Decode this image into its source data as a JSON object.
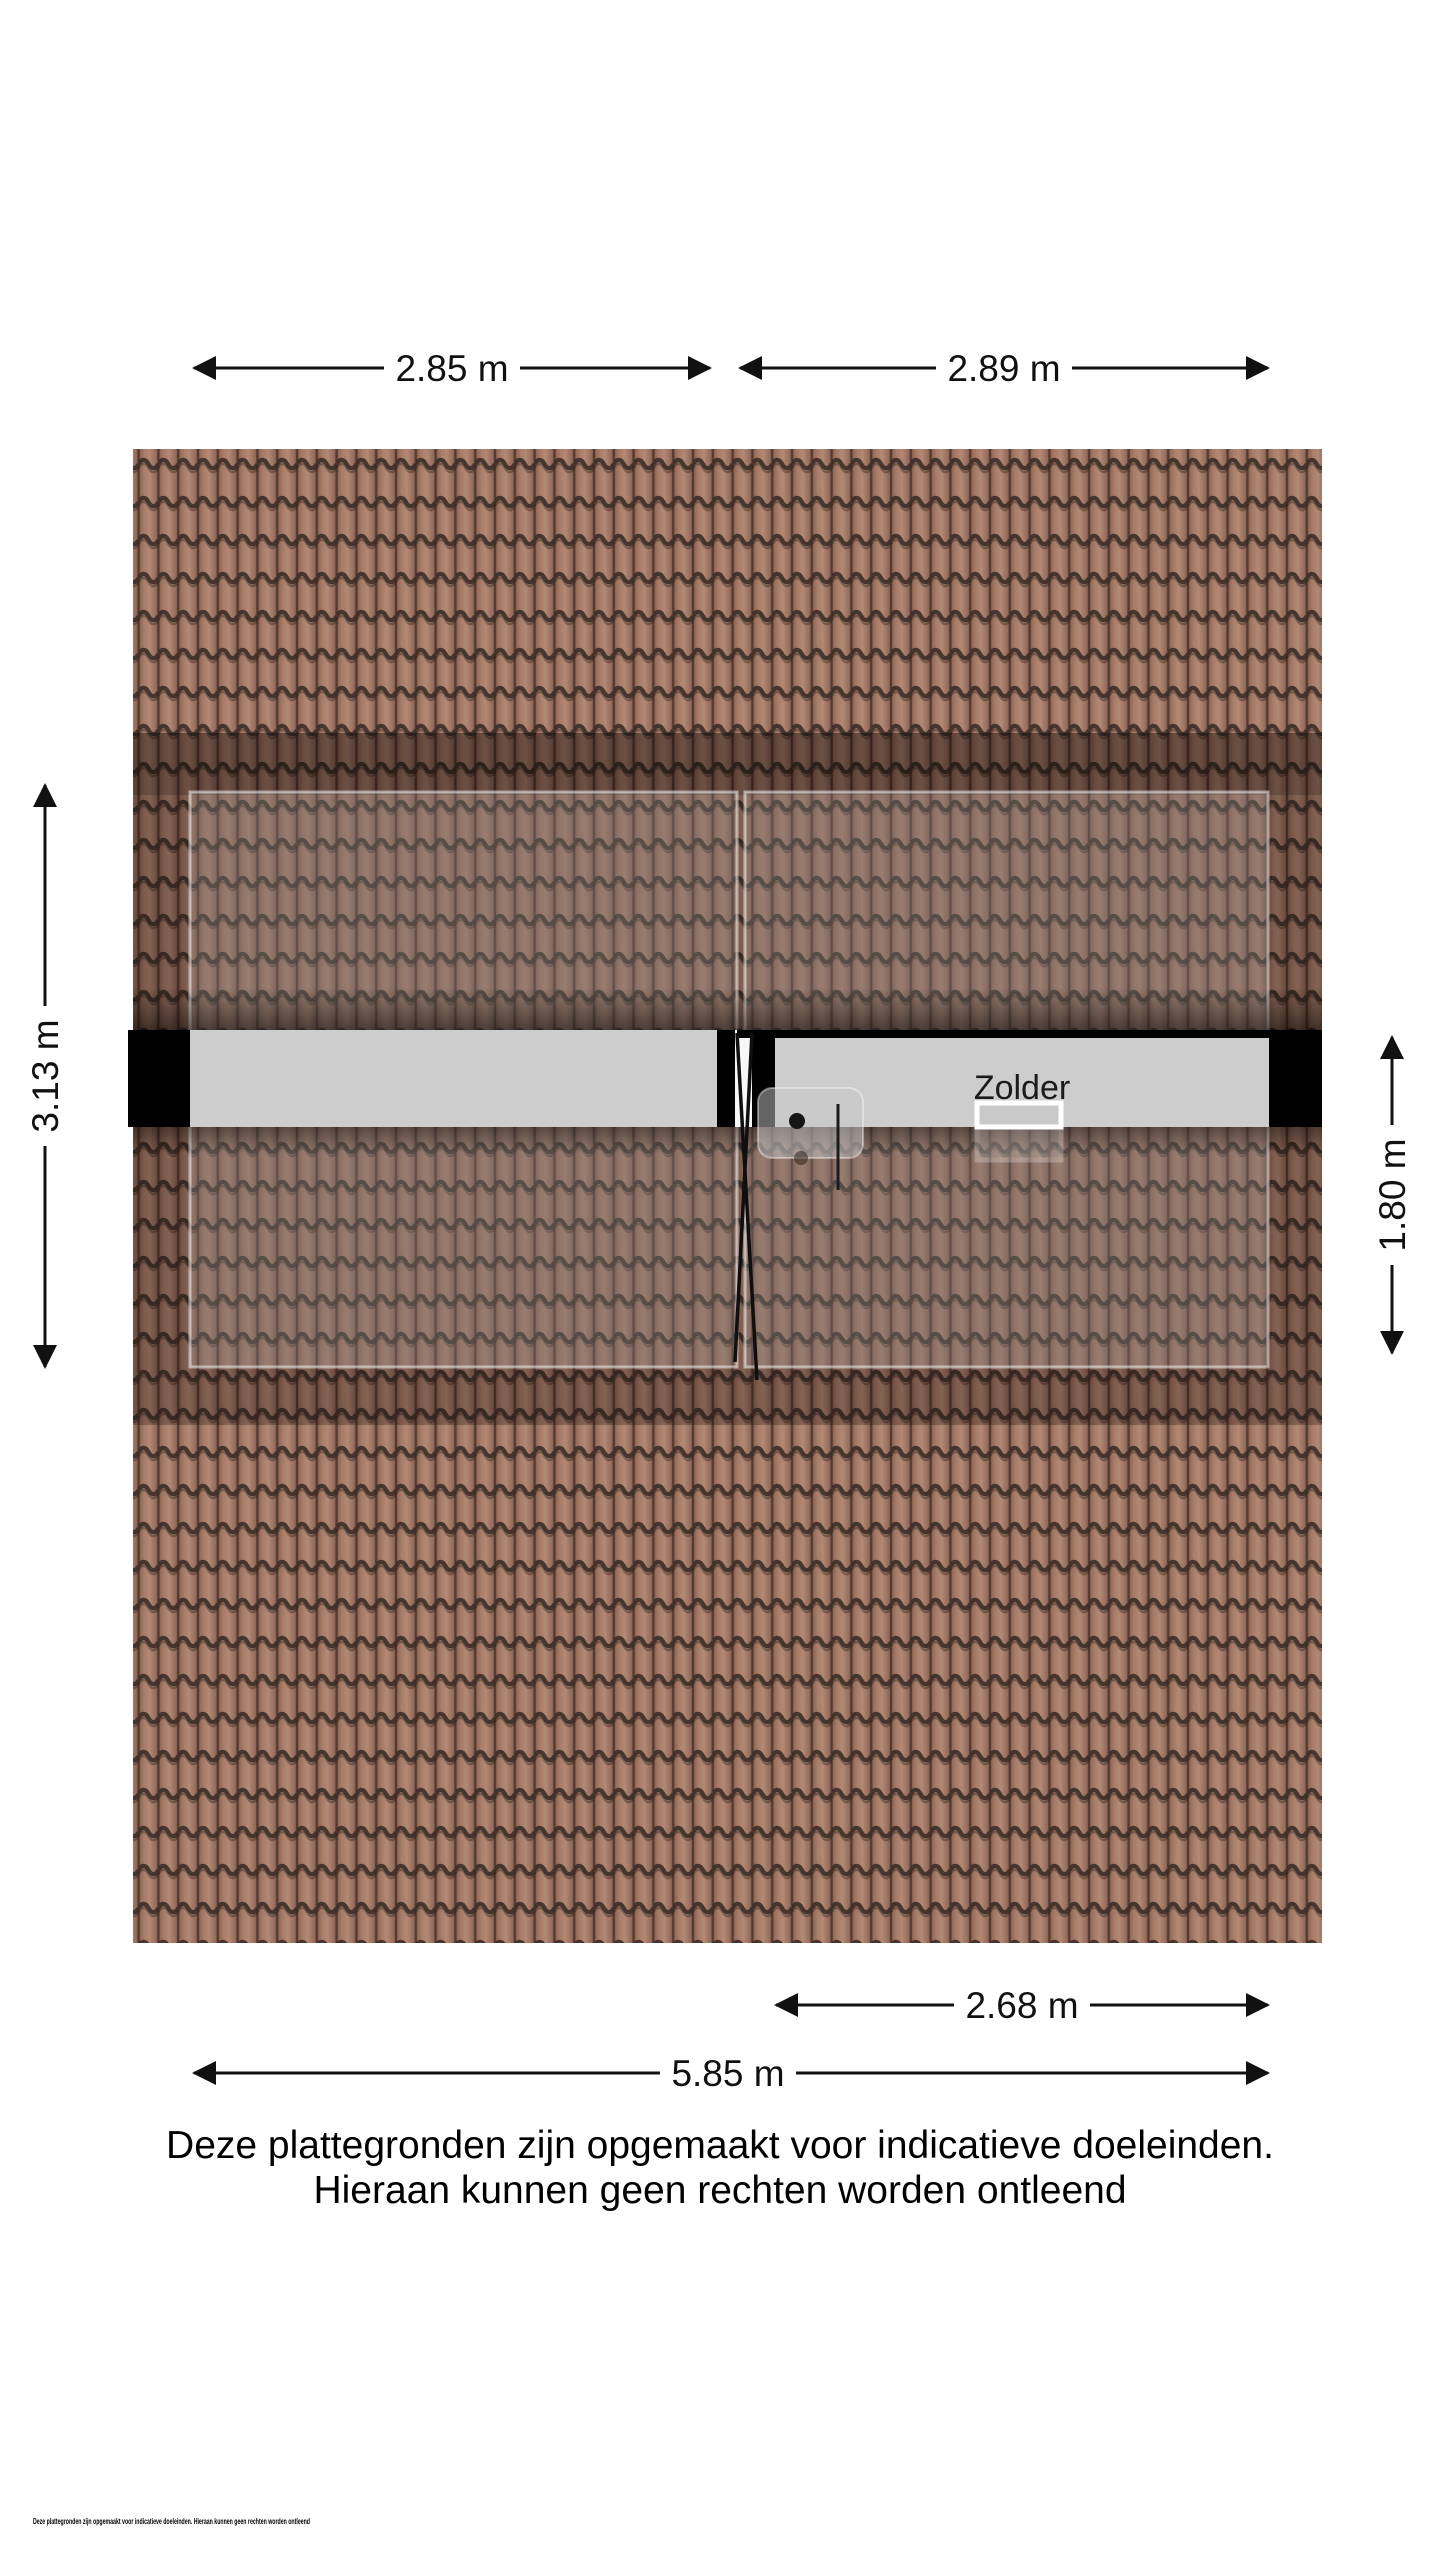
{
  "plan": {
    "room_label": "Zolder",
    "dimensions": {
      "top_left": "2.85 m",
      "top_right": "2.89 m",
      "left_height": "3.13 m",
      "right_height": "1.80 m",
      "bottom_room": "2.68 m",
      "bottom_total": "5.85 m"
    },
    "colors": {
      "tile_base": "#a87e6a",
      "tile_dark_line": "#3b2e27",
      "roof_shade_band": "rgba(26,13,9,0.30)",
      "floor": "#cdcdcd",
      "wall": "#000000",
      "dimension_ink": "#111111"
    }
  },
  "disclaimer": {
    "line1": "Deze plattegronden zijn opgemaakt voor indicatieve doeleinden.",
    "line2": "Hieraan kunnen geen rechten worden ontleend"
  },
  "footer": {
    "small_print": "Deze plattegronden zijn opgemaakt voor indicatieve doeleinden. Hieraan kunnen geen rechten worden ontleend"
  }
}
